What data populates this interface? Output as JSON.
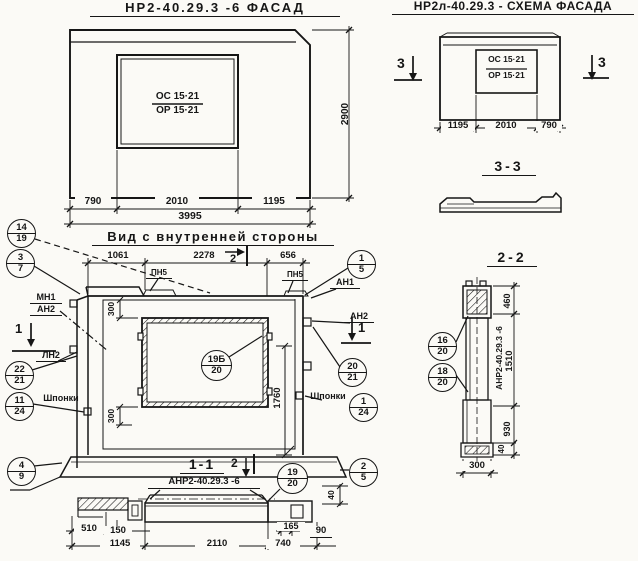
{
  "facade_left": {
    "title": "НР2-40.29.3 -6  ФАСАД",
    "window": {
      "top": "ОС 15·21",
      "bottom": "ОР 15·21"
    },
    "dims": {
      "d1": "790",
      "d2": "2010",
      "d3": "1195",
      "total": "3995",
      "height": "2900"
    }
  },
  "facade_right": {
    "title": "НР2л-40.29.3 - СХЕМА ФАСАДА",
    "window": {
      "top": "ОС 15·21",
      "bottom": "ОР 15·21"
    },
    "dims": {
      "d1": "1195",
      "d2": "2010",
      "d3": "790"
    },
    "section_mark": "3"
  },
  "section33": {
    "title": "3-3"
  },
  "inner_view": {
    "title": "Вид с внутренней стороны",
    "dims_top": {
      "d1": "1061",
      "d2": "2278",
      "d3": "656"
    },
    "dims": {
      "w300a": "300",
      "w300b": "300",
      "v": "1760"
    },
    "labels": {
      "pn5": "ПН5",
      "an1": "АН1",
      "an2": "АН2",
      "mn1": "МН1",
      "ln2": "ЛН2",
      "shponki": "Шпонки"
    },
    "marks": {
      "s1": "1",
      "s2": "2"
    },
    "callouts": {
      "c14_19": [
        "14",
        "19"
      ],
      "c3_7": [
        "3",
        "7"
      ],
      "c22_21": [
        "22",
        "21"
      ],
      "c11_24": [
        "11",
        "24"
      ],
      "c4_9": [
        "4",
        "9"
      ],
      "c1_5": [
        "1",
        "5"
      ],
      "c20_21": [
        "20",
        "21"
      ],
      "c1_24": [
        "1",
        "24"
      ],
      "c2_5": [
        "2",
        "5"
      ],
      "c19b_20": [
        "19Б",
        "20"
      ]
    }
  },
  "section11": {
    "title": "1-1",
    "label": "АНР2-40.29.3 -6",
    "callout_19_20": [
      "19",
      "20"
    ],
    "dims": {
      "d510": "510",
      "d150": "150",
      "d1145": "1145",
      "d2110": "2110",
      "d165": "165",
      "d740": "740",
      "d90": "90",
      "d40": "40"
    }
  },
  "section22": {
    "title": "2-2",
    "label": "АНР2-40.29.3 -6",
    "callouts": {
      "c16_20": [
        "16",
        "20"
      ],
      "c18_20": [
        "18",
        "20"
      ]
    },
    "dims": {
      "d460": "460",
      "d1510": "1510",
      "d930": "930",
      "d40": "40",
      "d300": "300"
    }
  }
}
